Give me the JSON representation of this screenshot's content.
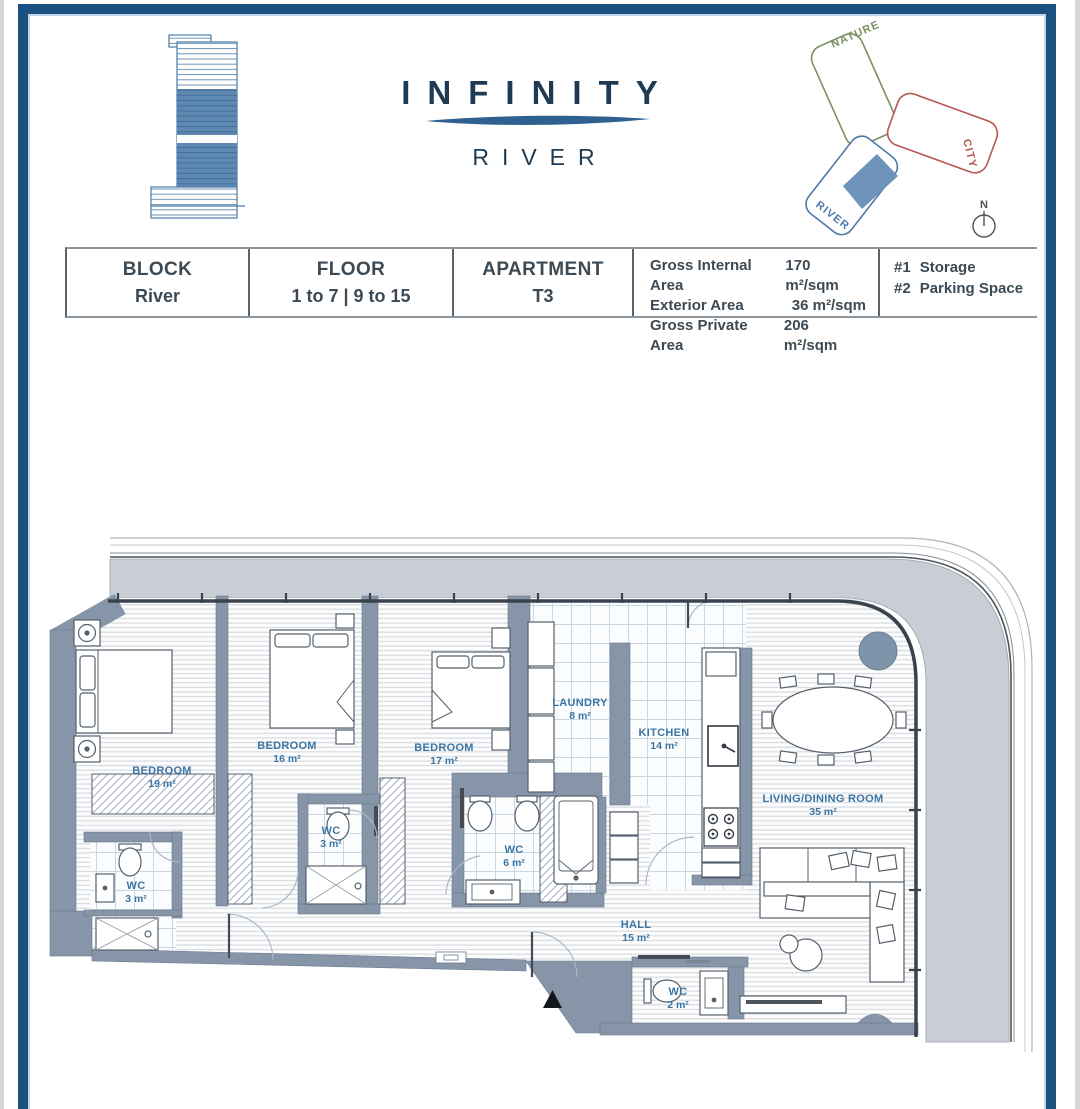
{
  "brand": {
    "title": "INFINITY",
    "subtitle": "RIVER"
  },
  "site_diagram": {
    "nature": "NATURE",
    "city": "CITY",
    "river": "RIVER",
    "compass": "N"
  },
  "info_table": {
    "columns": [
      {
        "label": "BLOCK",
        "value": "River"
      },
      {
        "label": "FLOOR",
        "value": "1 to 7 | 9 to 15"
      },
      {
        "label": "APARTMENT",
        "value": "T3"
      }
    ],
    "areas": [
      {
        "label": "Gross Internal Area",
        "value": "170 m²/sqm"
      },
      {
        "label": "Exterior Area",
        "value": "36 m²/sqm"
      },
      {
        "label": "Gross Private Area",
        "value": "206 m²/sqm"
      }
    ],
    "extras": [
      {
        "num": "#1",
        "label": "Storage"
      },
      {
        "num": "#2",
        "label": "Parking Space"
      }
    ]
  },
  "floor_plan": {
    "rooms": [
      {
        "name": "BEDROOM",
        "area": "19 m²"
      },
      {
        "name": "BEDROOM",
        "area": "16 m²"
      },
      {
        "name": "BEDROOM",
        "area": "17 m²"
      },
      {
        "name": "LAUNDRY",
        "area": "8 m²"
      },
      {
        "name": "KITCHEN",
        "area": "14 m²"
      },
      {
        "name": "LIVING/DINING ROOM",
        "area": "35 m²"
      },
      {
        "name": "WC",
        "area": "3 m²"
      },
      {
        "name": "WC",
        "area": "3 m²"
      },
      {
        "name": "WC",
        "area": "6 m²"
      },
      {
        "name": "HALL",
        "area": "15 m²"
      },
      {
        "name": "WC",
        "area": "2 m²"
      }
    ]
  },
  "colors": {
    "frame": "#1a5180",
    "wall": "#8795a9",
    "terrace": "#c9ced6",
    "room_label": "#3c76a4",
    "nature": "#7a9163",
    "city": "#b75653",
    "river": "#4d7ba9"
  }
}
